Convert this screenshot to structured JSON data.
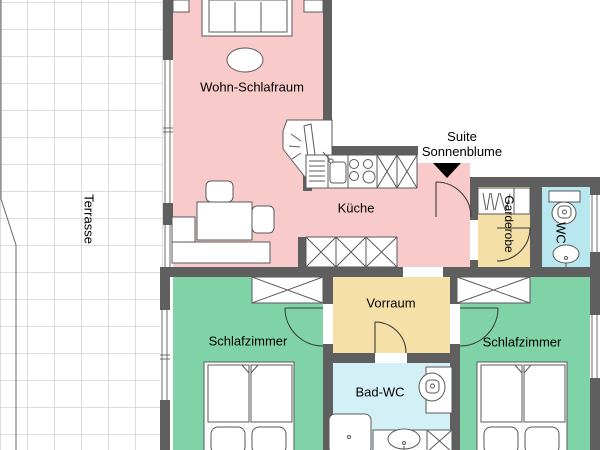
{
  "plan": {
    "suite_label": {
      "line1": "Suite",
      "line2": "Sonnenblume"
    },
    "rooms": [
      {
        "id": "terrasse",
        "name": "Terrasse",
        "color": "#ffffff"
      },
      {
        "id": "wohn-schlafraum",
        "name": "Wohn-Schlafraum",
        "color": "#f8caca"
      },
      {
        "id": "kueche",
        "name": "Küche",
        "color": "#f8caca"
      },
      {
        "id": "garderobe",
        "name": "Garderobe",
        "color": "#f4dfa6"
      },
      {
        "id": "wc",
        "name": "WC",
        "color": "#b9e7ef"
      },
      {
        "id": "vorraum",
        "name": "Vorraum",
        "color": "#f5e0a8"
      },
      {
        "id": "schlafzimmer-links",
        "name": "Schlafzimmer",
        "color": "#7fd3a6"
      },
      {
        "id": "schlafzimmer-rechts",
        "name": "Schlafzimmer",
        "color": "#7fd3a6"
      },
      {
        "id": "bad-wc",
        "name": "Bad-WC",
        "color": "#d4f0f7"
      }
    ],
    "icons": {
      "entrance_arrow": "filled-triangle-down"
    },
    "colors": {
      "wall": "#5f5f5f",
      "bedroom": "#7fd3a6",
      "living": "#f8caca",
      "hall": "#f5e0a8",
      "wc": "#b9e7ef",
      "bath": "#d4f0f7",
      "arrow": "#000000"
    }
  }
}
